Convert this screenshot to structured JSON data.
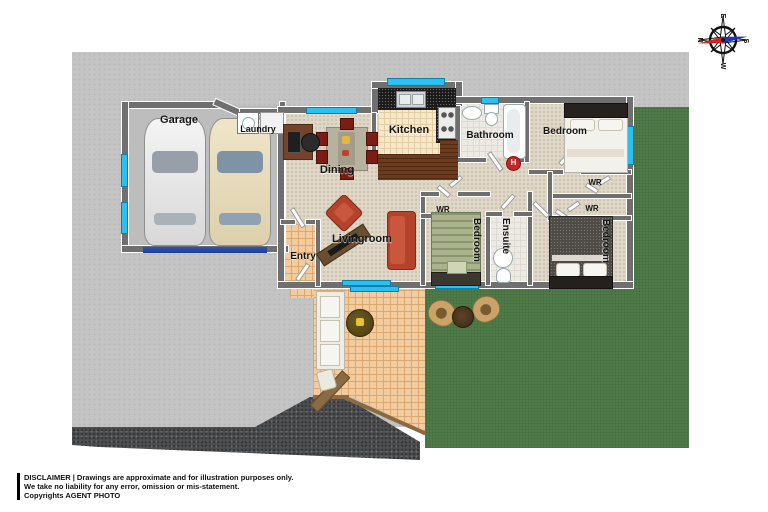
{
  "colors": {
    "concrete": "#c4c4c4",
    "lawn": "#4f7b48",
    "asphalt": "#4a4c4e",
    "wall": "#6f6f6f",
    "window": "#2cc0f0",
    "garagedoor": "#1d3e96",
    "carpet": "#ded6c7",
    "patiotile": "#f2cc9e",
    "kitchentile": "#f7e8ca",
    "granite": "#1b1b1b",
    "woodcounter": "#6e3a1c",
    "sofa": "#b5432c",
    "diningchair": "#7a1d15",
    "hotwater": "#c42527",
    "bedgreen": "#a9b48a"
  },
  "labels": {
    "garage": "Garage",
    "laundry": "Laundry",
    "kitchen": "Kitchen",
    "bathroom": "Bathroom",
    "bedroom": "Bedroom",
    "dining": "Dining",
    "livingroom": "Livingroom",
    "entry": "Entry",
    "ensuite": "Ensuite",
    "wr": "WR",
    "hot_water": "H"
  },
  "compass": {
    "north": "N",
    "east": "E",
    "south": "S",
    "west": "W"
  },
  "footer": {
    "line1": "DISCLAIMER | Drawings are approximate and for illustration purposes only.",
    "line2": "We take no liability for any error, omission or mis-statement.",
    "line3": "Copyrights AGENT PHOTO"
  }
}
